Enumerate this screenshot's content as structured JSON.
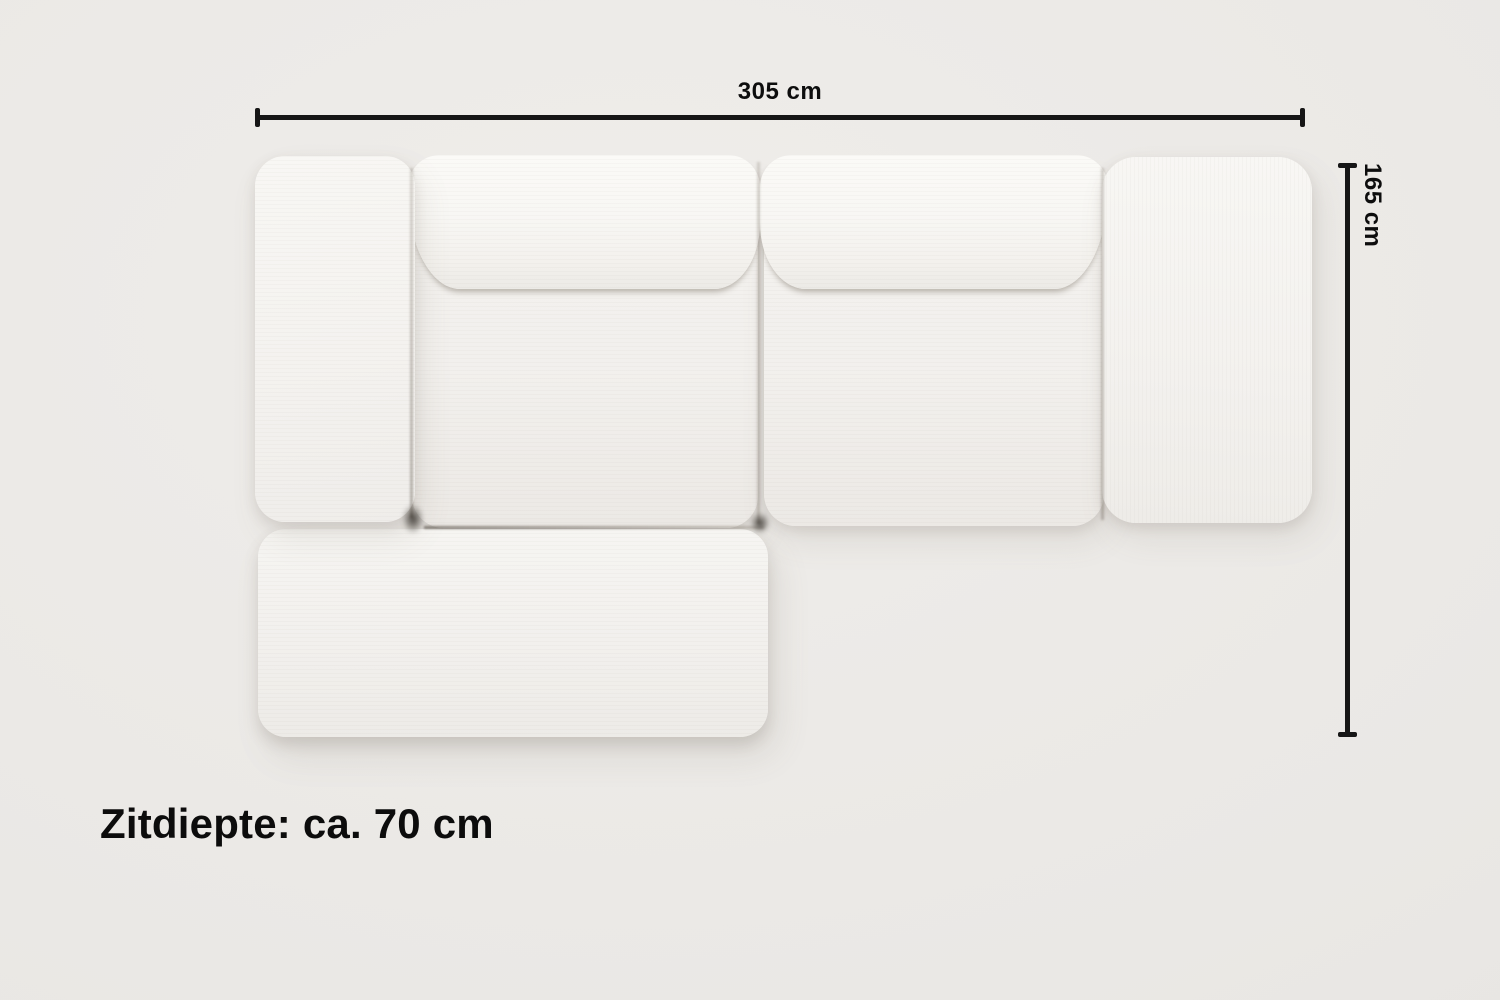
{
  "diagram": {
    "type": "sofa-top-view-dimension-diagram",
    "width_label": "305 cm",
    "depth_label": "165 cm",
    "seat_depth_label": "Zitdiepte: ca. 70 cm"
  },
  "sofa": {
    "parts": [
      "left-armrest",
      "backrest-cushion-left",
      "seat-section-left",
      "backrest-cushion-right",
      "seat-section-right",
      "right-armrest",
      "chaise-ottoman"
    ]
  },
  "colors": {
    "background": "#eae8e5",
    "sofa_fabric": "#f5f4f1",
    "dimension_line": "#161616",
    "text": "#0d0d0d"
  }
}
